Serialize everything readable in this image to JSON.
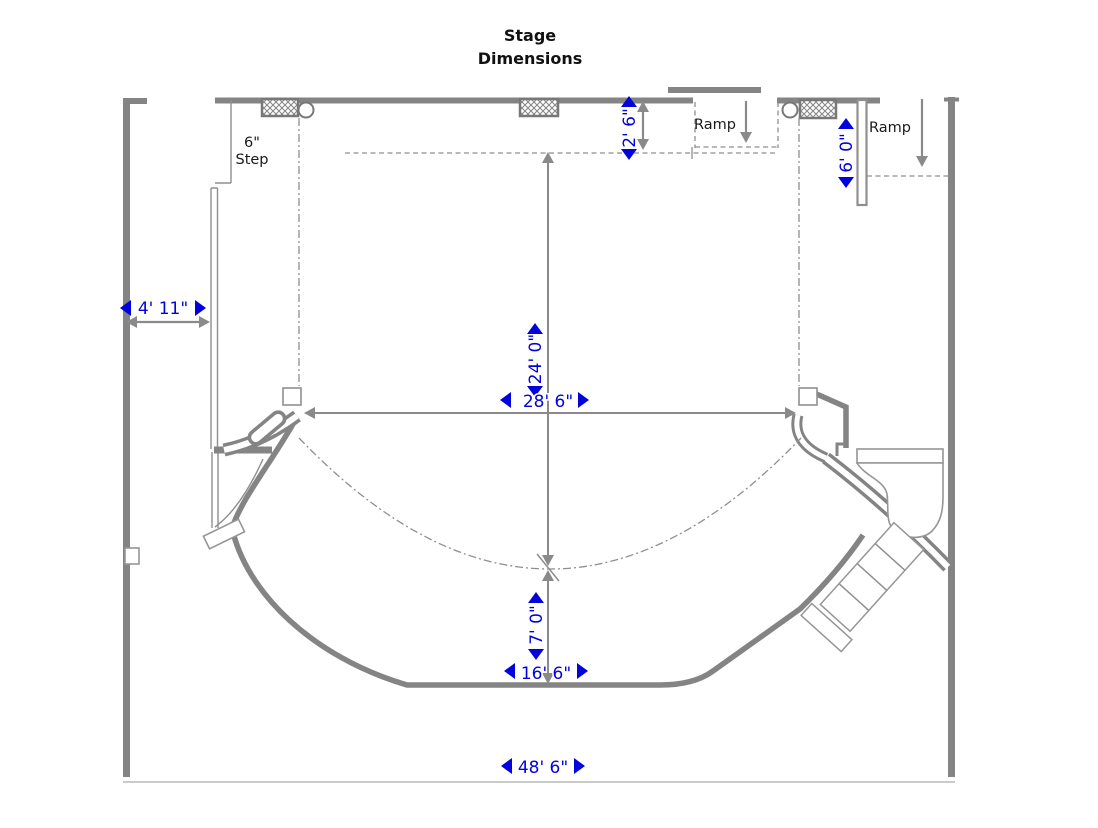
{
  "title": {
    "line1": "Stage",
    "line2": "Dimensions"
  },
  "annotations": {
    "step_line1": "6\"",
    "step_line2": "Step",
    "ramp_top": "Ramp",
    "ramp_right": "Ramp"
  },
  "dimensions": {
    "proscenium_offset": "2' 6\"",
    "left_entry_width": "4' 11\"",
    "stage_depth": "24' 0\"",
    "proscenium_width": "28' 6\"",
    "apron_depth": "7' 0\"",
    "apron_front_width": "16' 6\"",
    "overall_width": "48' 6\"",
    "right_ramp_length": "6' 0\""
  },
  "colors": {
    "dimension_text": "#0202DD",
    "wall_gray": "#848484",
    "thin_line_gray": "#8F8F8F",
    "label_black": "#1A1A1A"
  }
}
